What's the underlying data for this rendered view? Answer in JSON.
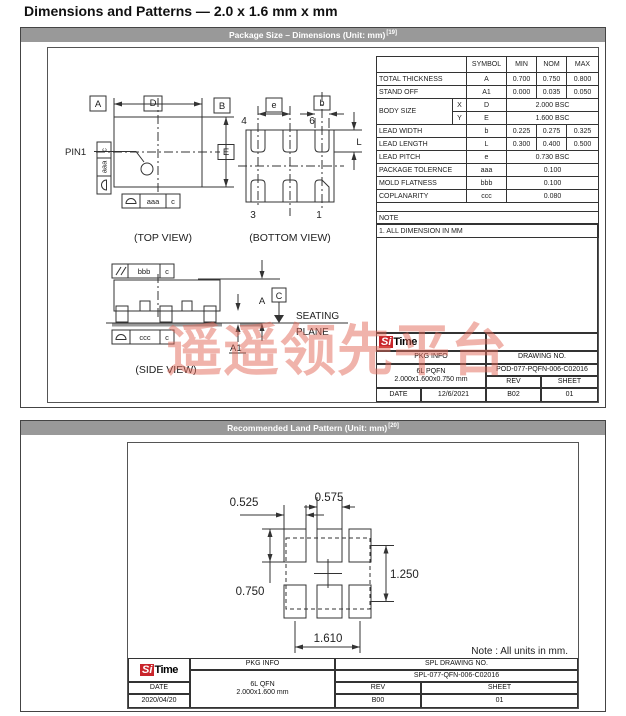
{
  "page": {
    "title": "Dimensions and Patterns — 2.0 x 1.6 mm x mm"
  },
  "watermark": {
    "text": "遥遥领先平台",
    "color": "rgba(226,104,88,0.5)"
  },
  "logo": {
    "si": "Si",
    "time": "Time"
  },
  "colors": {
    "header_bg": "#999999",
    "logo_red": "#c9252b",
    "line": "#333333"
  },
  "section1": {
    "header": {
      "text": "Package Size – Dimensions (Unit: mm)",
      "sup": "[19]"
    },
    "top_view": {
      "caption": "(TOP VIEW)",
      "pin1_label": "PIN1",
      "datum_a": "A",
      "datum_b": "B",
      "dim_d": "D",
      "dim_e": "E",
      "fcf_side_ref": "c",
      "fcf_side_tol": "aaa",
      "fcf_bottom_tol": "aaa",
      "fcf_bottom_ref": "c"
    },
    "bottom_view": {
      "caption": "(BOTTOM VIEW)",
      "dim_e": "e",
      "dim_b": "b",
      "dim_l": "L",
      "pin4": "4",
      "pin6": "6",
      "pin3": "3",
      "pin1": "1"
    },
    "side_view": {
      "caption": "(SIDE VIEW)",
      "fcf_top_tol": "bbb",
      "fcf_top_ref": "c",
      "fcf_bottom_tol": "ccc",
      "fcf_bottom_ref": "c",
      "dim_a": "A",
      "dim_a1": "A1",
      "datum_c": "C",
      "seating1": "SEATING",
      "seating2": "PLANE"
    },
    "table": {
      "headers": {
        "symbol": "SYMBOL",
        "min": "MIN",
        "nom": "NOM",
        "max": "MAX"
      },
      "rows": [
        {
          "name": "TOTAL THICKNESS",
          "symbol": "A",
          "min": "0.700",
          "nom": "0.750",
          "max": "0.800"
        },
        {
          "name": "STAND OFF",
          "symbol": "A1",
          "min": "0.000",
          "nom": "0.035",
          "max": "0.050"
        },
        {
          "name": "BODY SIZE",
          "sub": "X",
          "symbol": "D",
          "span": "2.000 BSC"
        },
        {
          "sub": "Y",
          "symbol": "E",
          "span": "1.600 BSC"
        },
        {
          "name": "LEAD WIDTH",
          "symbol": "b",
          "min": "0.225",
          "nom": "0.275",
          "max": "0.325"
        },
        {
          "name": "LEAD LENGTH",
          "symbol": "L",
          "min": "0.300",
          "nom": "0.400",
          "max": "0.500"
        },
        {
          "name": "LEAD PITCH",
          "symbol": "e",
          "span": "0.730 BSC"
        },
        {
          "name": "PACKAGE TOLERNCE",
          "symbol": "aaa",
          "span": "0.100"
        },
        {
          "name": "MOLD FLATNESS",
          "symbol": "bbb",
          "span": "0.100"
        },
        {
          "name": "COPLANARITY",
          "symbol": "ccc",
          "span": "0.080"
        }
      ],
      "note_label": "NOTE",
      "note_text": "1. ALL DIMENSION IN MM"
    },
    "title_block": {
      "pkg_info_label": "PKG INFO",
      "drawing_no_label": "DRAWING NO.",
      "pkg_line1": "6L PQFN",
      "pkg_line2": "2.000x1.600x0.750 mm",
      "drawing_no": "POD-077-PQFN-006-C02016",
      "rev_label": "REV",
      "sheet_label": "SHEET",
      "date_label": "DATE",
      "date": "12/6/2021",
      "rev": "B02",
      "sheet": "01"
    }
  },
  "section2": {
    "header": {
      "text": "Recommended Land Pattern (Unit: mm)",
      "sup": "[20]"
    },
    "dims": {
      "outer_pad_width": "0.525",
      "center_pad_width": "0.575",
      "pad_height": "0.750",
      "row_pitch": "1.250",
      "col_span": "1.610"
    },
    "note": "Note : All units in mm.",
    "title_block": {
      "pkg_info_label": "PKG INFO",
      "drawing_no_label": "SPL DRAWING NO.",
      "pkg_line1": "6L QFN",
      "pkg_line2": "2.000x1.600 mm",
      "drawing_no": "SPL-077-QFN-006-C02016",
      "rev_label": "REV",
      "sheet_label": "SHEET",
      "date_label": "DATE",
      "date": "2020/04/20",
      "rev": "B00",
      "sheet": "01"
    }
  }
}
